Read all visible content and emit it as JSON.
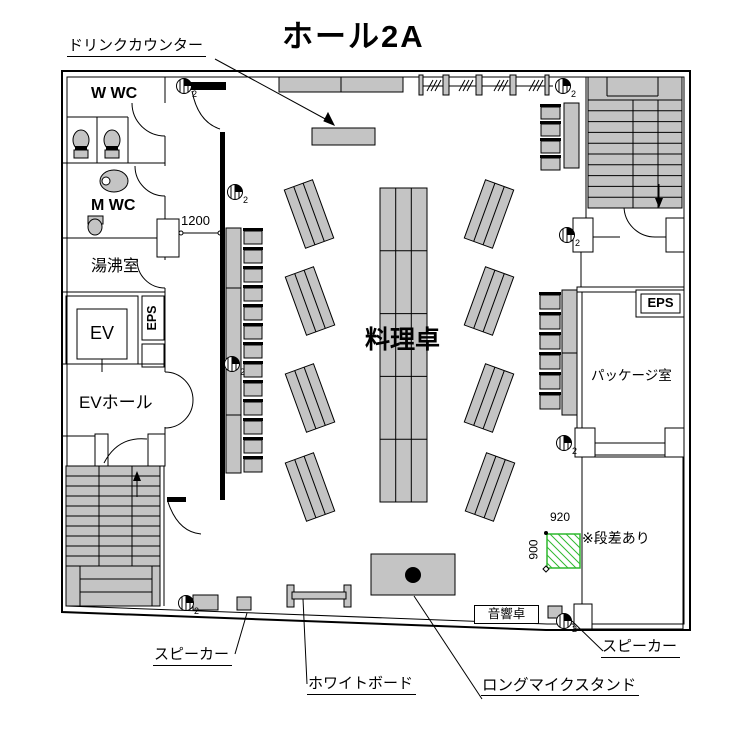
{
  "title": "ホール2A",
  "rooms": {
    "w_wc": "W WC",
    "m_wc": "M WC",
    "water_heater_room": "湯沸室",
    "elevator": "EV",
    "eps_left": "EPS",
    "ev_hall": "EVホール",
    "package_room": "パッケージ室",
    "eps_right": "EPS"
  },
  "annotations": {
    "drink_counter": "ドリンクカウンター",
    "cooking_table": "料理卓",
    "sound_desk": "音響卓",
    "speaker_left": "スピーカー",
    "speaker_right": "スピーカー",
    "whiteboard": "ホワイトボード",
    "long_mic_stand": "ロングマイクスタンド",
    "step_note": "※段差あり"
  },
  "dimensions": {
    "partition_opening": "1200",
    "step_area_width": "920",
    "step_area_depth": "900"
  },
  "symbols": {
    "column_mark": "2"
  },
  "colors": {
    "furniture_gray": "#c4c4c4",
    "step_area_green": "#2eb82e",
    "line": "#000000"
  }
}
